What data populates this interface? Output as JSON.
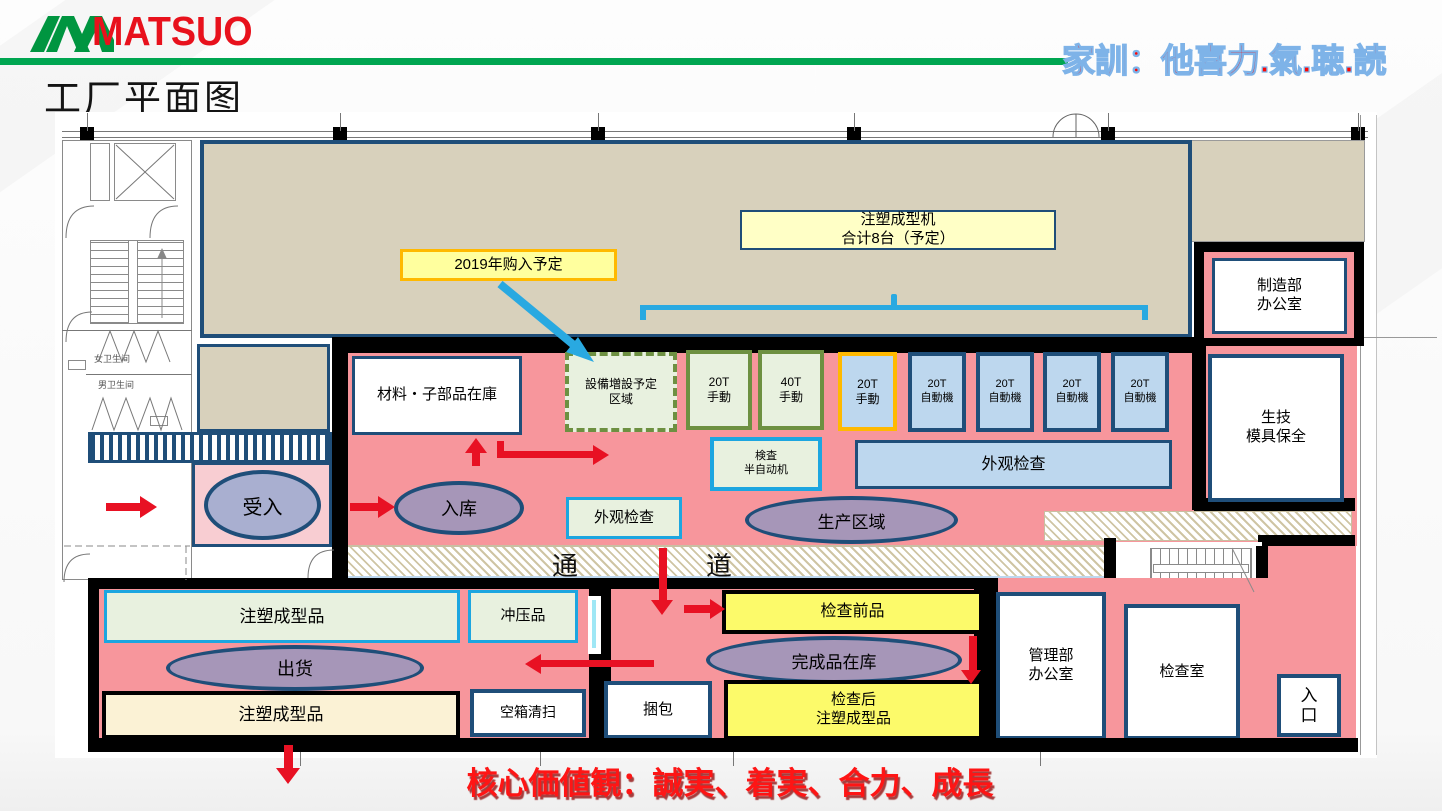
{
  "colors": {
    "brand_green": "#00A651",
    "brand_red": "#E8111C",
    "floor_pink": "#F7969C",
    "light_pink": "#F8CDD2",
    "hall_tan": "#D8D1BC",
    "dark_blue": "#1F4E79",
    "cyan_border": "#1CA6E0",
    "sky_blue": "#29A9E1",
    "light_blue": "#BDD7EE",
    "light_green": "#E8F1DF",
    "olive_green": "#6D9041",
    "orange": "#FFB900",
    "bright_yellow": "#FCFA6A",
    "pale_yellow": "#FFFFC6",
    "label_yellow": "#FFFF9E",
    "cream": "#FBF2D5",
    "zone_purple": "#A696B8",
    "zone_blue_gray": "#A9AFD0",
    "arrow_red": "#E81123"
  },
  "header": {
    "logo": "MATSUO",
    "motto": "家訓：他喜力.氣.聴.読",
    "title": "工厂平面图"
  },
  "plan": {
    "hall_label_line1": "注塑成型机",
    "hall_label_line2": "合计8台（予定）",
    "purchase_label": "2019年购入予定",
    "expansion_line1": "設備増設予定",
    "expansion_line2": "区域",
    "machines": [
      {
        "l1": "20T",
        "l2": "手動"
      },
      {
        "l1": "40T",
        "l2": "手動"
      },
      {
        "l1": "20T",
        "l2": "手動"
      },
      {
        "l1": "20T",
        "l2": "自動機"
      },
      {
        "l1": "20T",
        "l2": "自動機"
      },
      {
        "l1": "20T",
        "l2": "自動機"
      },
      {
        "l1": "20T",
        "l2": "自動機"
      }
    ],
    "rooms": {
      "material_stock": "材料・子部品在庫",
      "semi_auto_line1": "検査",
      "semi_auto_line2": "半自动机",
      "visual_inspection_big": "外观检查",
      "visual_inspection_small": "外观检查",
      "mfg_office_line1": "制造部",
      "mfg_office_line2": "办公室",
      "tech_mold_line1": "生技",
      "tech_mold_line2": "模具保全",
      "admin_office_line1": "管理部",
      "admin_office_line2": "办公室",
      "inspection_room": "检查室",
      "entrance_line1": "入",
      "entrance_line2": "口",
      "toilet_female": "女卫生间",
      "toilet_male": "男卫生间"
    },
    "zones": {
      "receiving": "受入",
      "inbound": "入库",
      "production": "生产区域",
      "shipping": "出货",
      "finished_goods": "完成品在库"
    },
    "corridor_char1": "通",
    "corridor_char2": "道",
    "storage": {
      "molded_parts_top": "注塑成型品",
      "stamped_parts": "冲压品",
      "molded_parts_bottom": "注塑成型品",
      "empty_box_clean": "空箱清扫",
      "pre_inspection": "检查前品",
      "packing": "捆包",
      "post_inspection_line1": "检查后",
      "post_inspection_line2": "注塑成型品"
    }
  },
  "footer": {
    "core_values": "核心価値観：誠実、着実、合力、成長"
  }
}
